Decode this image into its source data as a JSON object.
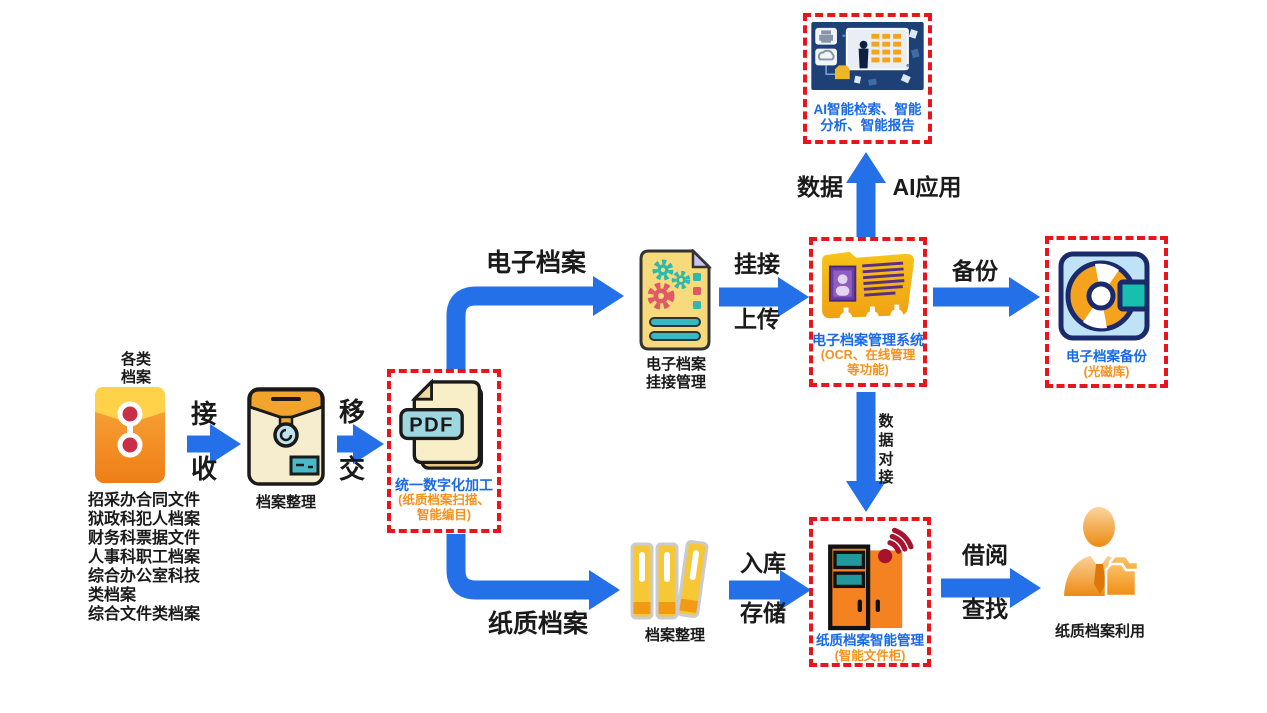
{
  "diagram": {
    "nodes": {
      "source": {
        "title_lines": [
          "各类",
          "档案"
        ],
        "doc_list": [
          "招采办合同文件",
          "狱政科犯人档案",
          "财务科票据文件",
          "人事科职工档案",
          "综合办公室科技",
          "类档案",
          "综合文件类档案"
        ]
      },
      "organize_in": {
        "label": "档案整理"
      },
      "digitize": {
        "badge": "PDF",
        "title": "统一数字化加工",
        "subtitle_lines": [
          "(纸质档案扫描、",
          "智能编目)"
        ]
      },
      "link_manage": {
        "label_lines": [
          "电子档案",
          "挂接管理"
        ]
      },
      "ems": {
        "title": "电子档案管理系统",
        "subtitle_lines": [
          "(OCR、在线管理",
          "等功能)"
        ]
      },
      "ai": {
        "title_lines": [
          "AI智能检索、智能",
          "分析、智能报告"
        ]
      },
      "backup": {
        "title": "电子档案备份",
        "subtitle": "(光磁库)"
      },
      "cabinet": {
        "title": "纸质档案智能管理",
        "subtitle": "(智能文件柜)"
      },
      "organize_out": {
        "label": "档案整理"
      },
      "usage": {
        "label": "纸质档案利用"
      }
    },
    "arrows": {
      "receive_lines": [
        "接",
        "收"
      ],
      "transfer_lines": [
        "移",
        "交"
      ],
      "electronic_label": "电子档案",
      "paper_label": "纸质档案",
      "link_upload_lines": [
        "挂接",
        "上传"
      ],
      "backup_label": "备份",
      "data_label": "数据",
      "ai_app_label": "AI应用",
      "data_connect_label": "数据对接",
      "store_lines": [
        "入库",
        "存储"
      ],
      "borrow_lines": [
        "借阅",
        "查找"
      ]
    },
    "colors": {
      "arrow_blue": "#2470E8",
      "box_dash_red": "#E8161C",
      "node_title_blue": "#1B6AE5",
      "node_subtitle_orange": "#F5921E"
    }
  }
}
